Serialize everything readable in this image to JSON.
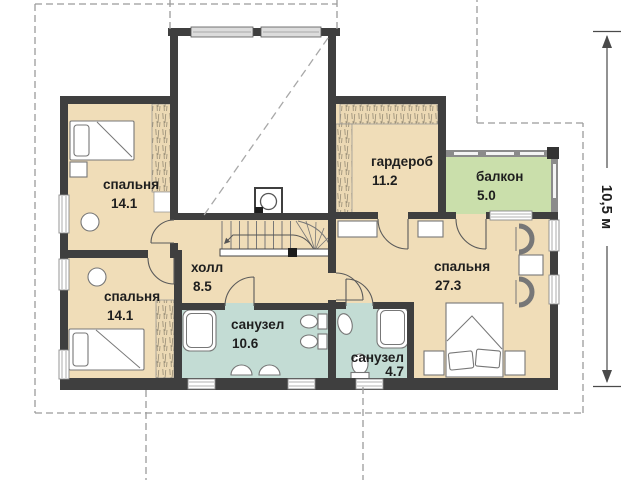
{
  "plan": {
    "type": "second-floor-plan",
    "rooms": {
      "bedroom_top_left": {
        "name": "спальня",
        "area": "14.1"
      },
      "bedroom_bottom_left": {
        "name": "спальня",
        "area": "14.1"
      },
      "hall": {
        "name": "холл",
        "area": "8.5"
      },
      "wardrobe": {
        "name": "гардероб",
        "area": "11.2"
      },
      "balcony": {
        "name": "балкон",
        "area": "5.0"
      },
      "master_bedroom": {
        "name": "спальня",
        "area": "27.3"
      },
      "bathroom_large": {
        "name": "санузел",
        "area": "10.6"
      },
      "bathroom_small": {
        "name": "санузел",
        "area": "4.7"
      }
    },
    "dimension": {
      "height_label": "10,5 м"
    },
    "colors": {
      "wall": "#3f3f3f",
      "room_floor": "#f0ddb8",
      "bathroom_floor": "#c3dcd4",
      "balcony_floor": "#cadfab",
      "balcony_parapet": "#8b8b8b",
      "roof_outline": "#9b9b9b",
      "background": "#ffffff"
    }
  }
}
